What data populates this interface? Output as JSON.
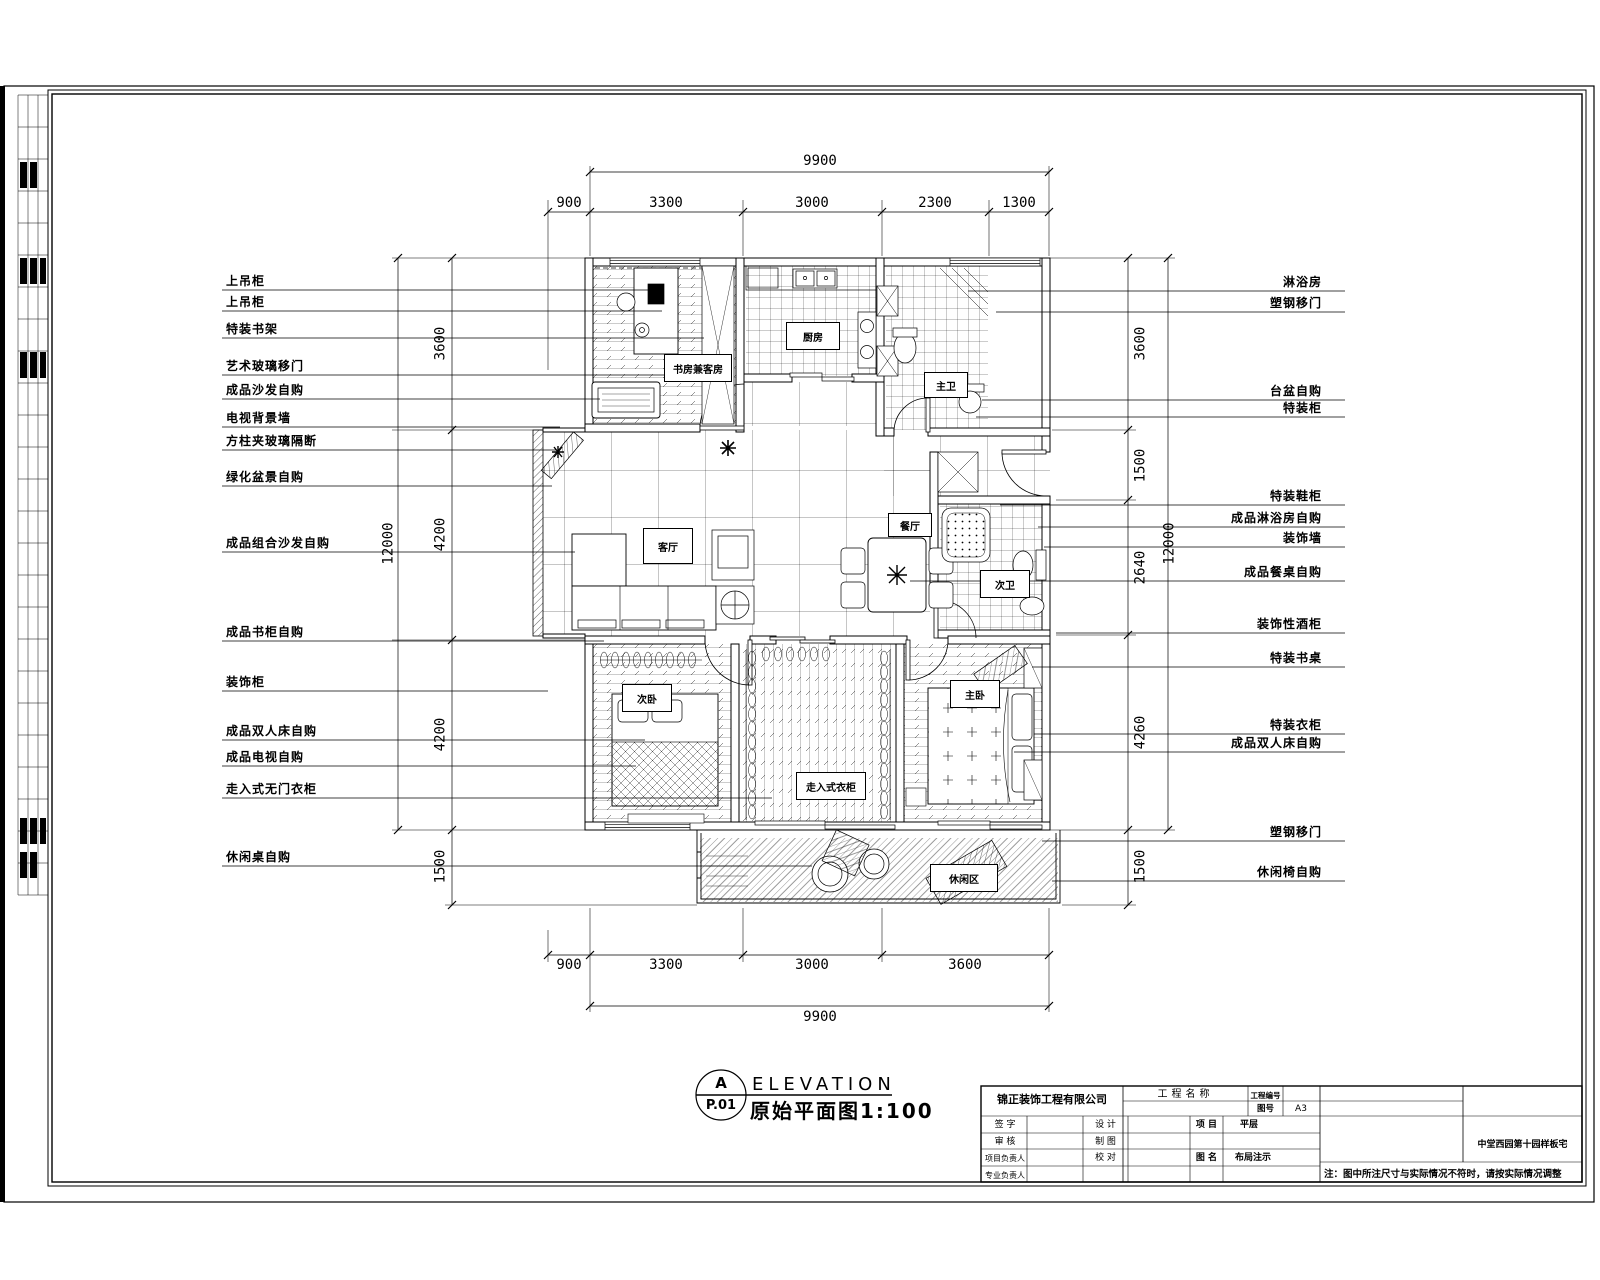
{
  "title": {
    "bubble_top": "A",
    "bubble_bottom": "P.01",
    "heading": "ELEVATION",
    "subheading": "原始平面图1:100"
  },
  "note": "注：图中所注尺寸与实际情况不符时，请按实际情况调整",
  "titleblock": {
    "company": "锦正装饰工程有限公司",
    "project_name_label": "工程名称",
    "project_no_label": "工程编号",
    "sheet_no_label": "图号",
    "sheet_no_value": "A3",
    "sign_label": "签  字",
    "review_label": "审  核",
    "pm_label": "项目负责人",
    "lead_label": "专业负责人",
    "design_label": "设  计",
    "draft_label": "制  图",
    "check_label": "校  对",
    "item_label": "项 目",
    "item_value": "平层",
    "dwg_label": "图 名",
    "dwg_value": "布局注示",
    "project_cell": "中堂西园第十园样板宅"
  },
  "dimensions": {
    "top": {
      "overall": "9900",
      "segments": [
        "900",
        "3300",
        "3000",
        "2300",
        "1300"
      ]
    },
    "bottom": {
      "overall": "9900",
      "segments": [
        "900",
        "3300",
        "3000",
        "3600"
      ]
    },
    "left": {
      "overall": "12000",
      "segments": [
        "3600",
        "4200",
        "4200"
      ],
      "balcony": "1500"
    },
    "right": {
      "overall": "12000",
      "segments": [
        "3600",
        "1500",
        "2640",
        "4260"
      ],
      "balcony": "1500"
    }
  },
  "annotations": {
    "left": [
      {
        "text": "上吊柜",
        "y": 290,
        "x2": 648
      },
      {
        "text": "上吊柜",
        "y": 311,
        "x2": 662
      },
      {
        "text": "特装书架",
        "y": 338,
        "x2": 704
      },
      {
        "text": "艺术玻璃移门",
        "y": 375,
        "x2": 706
      },
      {
        "text": "成品沙发自购",
        "y": 399,
        "x2": 600
      },
      {
        "text": "电视背景墙",
        "y": 427,
        "x2": 560
      },
      {
        "text": "方柱夹玻璃隔断",
        "y": 450,
        "x2": 556
      },
      {
        "text": "绿化盆景自购",
        "y": 486,
        "x2": 552
      },
      {
        "text": "成品组合沙发自购",
        "y": 552,
        "x2": 575
      },
      {
        "text": "成品书柜自购",
        "y": 641,
        "x2": 604
      },
      {
        "text": "装饰柜",
        "y": 691,
        "x2": 548
      },
      {
        "text": "成品双人床自购",
        "y": 740,
        "x2": 645
      },
      {
        "text": "成品电视自购",
        "y": 766,
        "x2": 636
      },
      {
        "text": "走入式无门衣柜",
        "y": 798,
        "x2": 772
      },
      {
        "text": "休闲桌自购",
        "y": 866,
        "x2": 812
      }
    ],
    "right": [
      {
        "text": "淋浴房",
        "y": 291,
        "x1": 968
      },
      {
        "text": "塑钢移门",
        "y": 312,
        "x1": 996
      },
      {
        "text": "台盆自购",
        "y": 400,
        "x1": 982
      },
      {
        "text": "特装柜",
        "y": 417,
        "x1": 976
      },
      {
        "text": "特装鞋柜",
        "y": 505,
        "x1": 1000
      },
      {
        "text": "成品淋浴房自购",
        "y": 527,
        "x1": 1038
      },
      {
        "text": "装饰墙",
        "y": 547,
        "x1": 1044
      },
      {
        "text": "成品餐桌自购",
        "y": 581,
        "x1": 910
      },
      {
        "text": "装饰性酒柜",
        "y": 633,
        "x1": 1056
      },
      {
        "text": "特装书桌",
        "y": 667,
        "x1": 1032
      },
      {
        "text": "特装衣柜",
        "y": 734,
        "x1": 1034
      },
      {
        "text": "成品双人床自购",
        "y": 752,
        "x1": 1014
      },
      {
        "text": "塑钢移门",
        "y": 841,
        "x1": 1042
      },
      {
        "text": "休闲椅自购",
        "y": 881,
        "x1": 1052
      }
    ]
  },
  "rooms": [
    {
      "name": "书房兼客房",
      "x": 664,
      "y": 354,
      "w": 66,
      "h": 26
    },
    {
      "name": "厨房",
      "x": 786,
      "y": 322,
      "w": 52,
      "h": 26
    },
    {
      "name": "主卫",
      "x": 924,
      "y": 372,
      "w": 42,
      "h": 24
    },
    {
      "name": "客厅",
      "x": 643,
      "y": 528,
      "w": 48,
      "h": 34
    },
    {
      "name": "餐厅",
      "x": 888,
      "y": 513,
      "w": 42,
      "h": 22
    },
    {
      "name": "次卫",
      "x": 980,
      "y": 570,
      "w": 48,
      "h": 26
    },
    {
      "name": "次卧",
      "x": 622,
      "y": 684,
      "w": 48,
      "h": 26
    },
    {
      "name": "主卧",
      "x": 950,
      "y": 680,
      "w": 48,
      "h": 26
    },
    {
      "name": "走入式衣柜",
      "x": 796,
      "y": 772,
      "w": 68,
      "h": 26
    },
    {
      "name": "休闲区",
      "x": 930,
      "y": 864,
      "w": 66,
      "h": 26
    }
  ]
}
